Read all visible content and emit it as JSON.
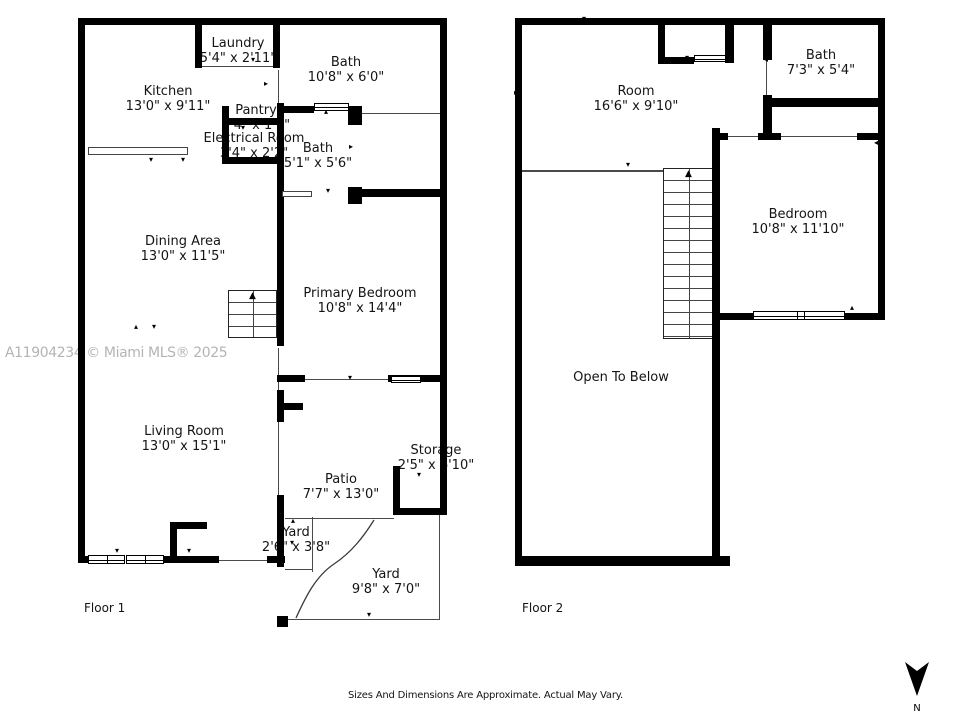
{
  "meta": {
    "watermark": "A11904234 © Miami MLS® 2025",
    "disclaimer": "Sizes And Dimensions Are Approximate. Actual May Vary.",
    "north_label": "N",
    "colors": {
      "wall": "#000000",
      "text": "#141414",
      "watermark": "#b4b4b4"
    },
    "icons": {
      "up_arrow": "▲",
      "tick_up": "▴",
      "tick_down": "▾",
      "tick_left": "◂",
      "tick_right": "▸"
    }
  },
  "floor1": {
    "label": "Floor 1",
    "rooms": [
      {
        "name": "Laundry",
        "dims": "5'4\" x 2'11\""
      },
      {
        "name": "Kitchen",
        "dims": "13'0\" x 9'11\""
      },
      {
        "name": "Bath",
        "dims": "10'8\" x 6'0\""
      },
      {
        "name": "Pantry",
        "dims": "3'4\" x 1'1\""
      },
      {
        "name": "Electrical Room",
        "dims": "3'4\" x 2'2\""
      },
      {
        "name": "Bath",
        "dims": "5'1\" x 5'6\""
      },
      {
        "name": "Dining Area",
        "dims": "13'0\" x 11'5\""
      },
      {
        "name": "Primary Bedroom",
        "dims": "10'8\" x 14'4\""
      },
      {
        "name": "Living Room",
        "dims": "13'0\" x 15'1\""
      },
      {
        "name": "Storage",
        "dims": "2'5\" x 6'10\""
      },
      {
        "name": "Patio",
        "dims": "7'7\" x 13'0\""
      },
      {
        "name": "Yard",
        "dims": "2'6\" x 3'8\""
      },
      {
        "name": "Yard",
        "dims": "9'8\" x 7'0\""
      }
    ]
  },
  "floor2": {
    "label": "Floor 2",
    "rooms": [
      {
        "name": "Room",
        "dims": "16'6\" x 9'10\""
      },
      {
        "name": "Bath",
        "dims": "7'3\" x 5'4\""
      },
      {
        "name": "Bedroom",
        "dims": "10'8\" x 11'10\""
      },
      {
        "name": "Open To Below",
        "dims": ""
      }
    ]
  },
  "ticks": [
    {
      "x": 82,
      "y": 84,
      "dir": "left"
    },
    {
      "x": 266,
      "y": 84,
      "dir": "right"
    },
    {
      "x": 151,
      "y": 160,
      "dir": "down"
    },
    {
      "x": 183,
      "y": 160,
      "dir": "down"
    },
    {
      "x": 243,
      "y": 128,
      "dir": "down"
    },
    {
      "x": 326,
      "y": 112,
      "dir": "up"
    },
    {
      "x": 351,
      "y": 147,
      "dir": "right"
    },
    {
      "x": 328,
      "y": 191,
      "dir": "down"
    },
    {
      "x": 136,
      "y": 327,
      "dir": "up"
    },
    {
      "x": 154,
      "y": 327,
      "dir": "down"
    },
    {
      "x": 281,
      "y": 295,
      "dir": "right"
    },
    {
      "x": 80,
      "y": 224,
      "dir": "left"
    },
    {
      "x": 80,
      "y": 450,
      "dir": "left"
    },
    {
      "x": 189,
      "y": 551,
      "dir": "down"
    },
    {
      "x": 293,
      "y": 521,
      "dir": "up"
    },
    {
      "x": 292,
      "y": 543,
      "dir": "down"
    },
    {
      "x": 350,
      "y": 378,
      "dir": "down"
    },
    {
      "x": 419,
      "y": 475,
      "dir": "down"
    },
    {
      "x": 369,
      "y": 615,
      "dir": "down"
    },
    {
      "x": 253,
      "y": 60,
      "dir": "down"
    },
    {
      "x": 117,
      "y": 551,
      "dir": "down"
    },
    {
      "x": 584,
      "y": 19,
      "dir": "down"
    },
    {
      "x": 816,
      "y": 21,
      "dir": "down"
    },
    {
      "x": 516,
      "y": 93,
      "dir": "right"
    },
    {
      "x": 687,
      "y": 58,
      "dir": "down"
    },
    {
      "x": 766,
      "y": 60,
      "dir": "left"
    },
    {
      "x": 853,
      "y": 103,
      "dir": "down"
    },
    {
      "x": 769,
      "y": 126,
      "dir": "up"
    },
    {
      "x": 852,
      "y": 308,
      "dir": "up"
    },
    {
      "x": 876,
      "y": 143,
      "dir": "left"
    },
    {
      "x": 628,
      "y": 165,
      "dir": "down"
    }
  ]
}
